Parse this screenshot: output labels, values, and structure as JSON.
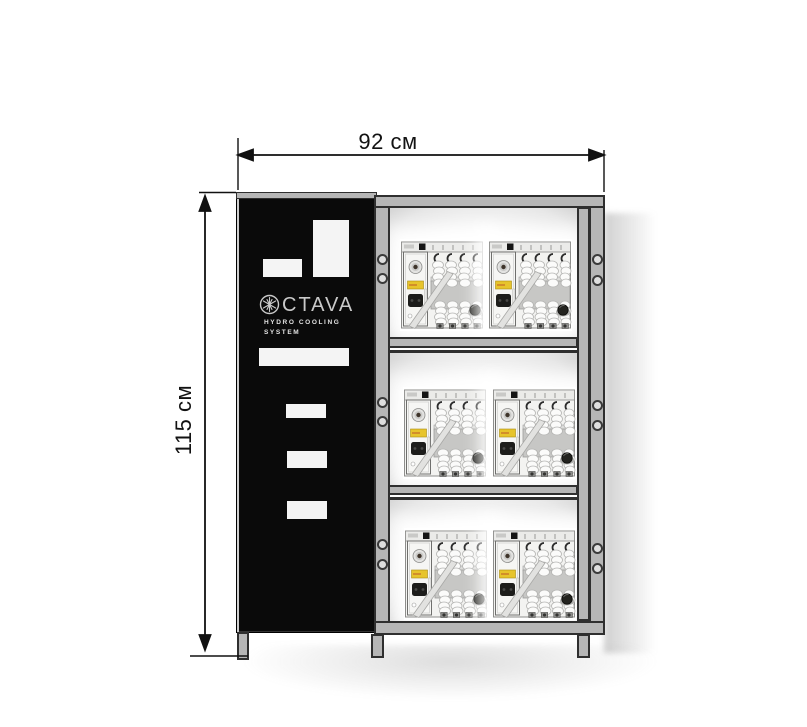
{
  "diagram": {
    "dimensions": {
      "width_label": "92 см",
      "height_label": "115 см"
    },
    "cabinet": {
      "logo": {
        "icon": "snowflake-circle-icon",
        "text": "CTAVA",
        "subtitle_line1": "HYDRO  COOLING",
        "subtitle_line2": "SYSTEM"
      },
      "panel_color": "#0a0a0a",
      "cutout_count": 6
    },
    "rack": {
      "rows": 3,
      "columns": 2,
      "frame_color": "#b6b6b6",
      "unit_icon": "hydro-cooling-unit",
      "unit_count": 6
    },
    "colors": {
      "dimension_line": "#111111",
      "unit_label_yellow": "#e7c42c",
      "background": "#ffffff"
    }
  }
}
